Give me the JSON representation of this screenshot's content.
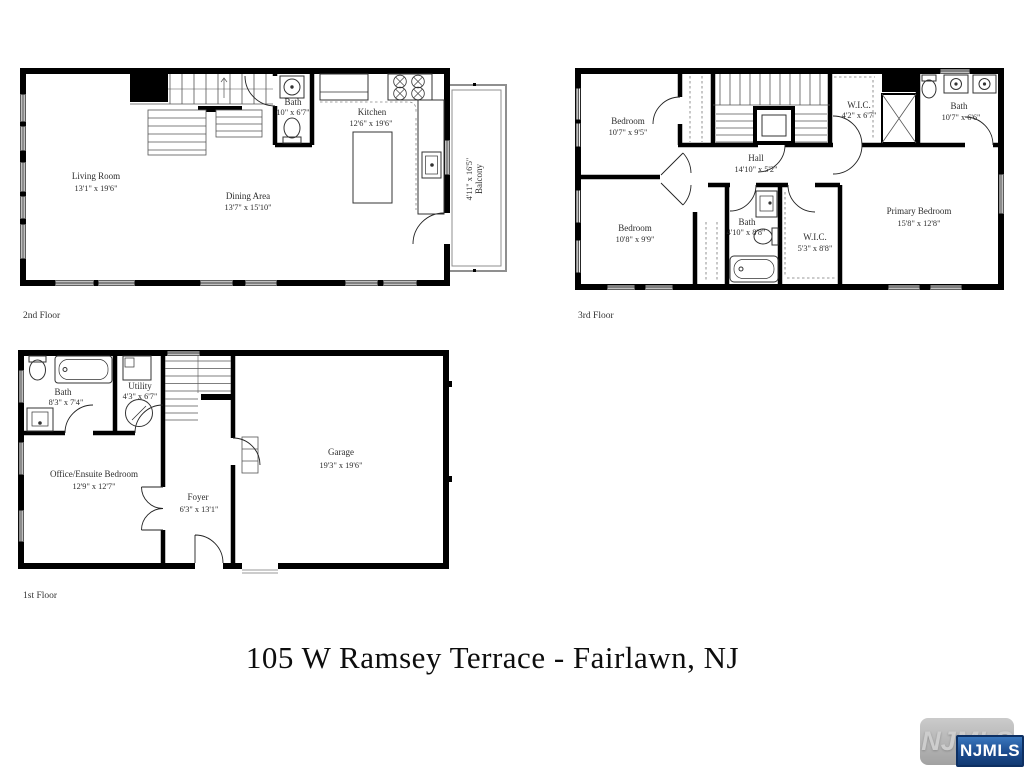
{
  "title": "105 W Ramsey Terrace - Fairlawn, NJ",
  "logo": {
    "watermark": "NJMLS",
    "badge": "NJMLS"
  },
  "colors": {
    "wall": "#000000",
    "balcony_outline": "#8f8f8f",
    "badge_blue_top": "#3a77bd",
    "badge_blue_bottom": "#123a72",
    "badge_border": "#0d2f62"
  },
  "floors": {
    "second": {
      "label": "2nd Floor",
      "rooms": {
        "living_room": {
          "name": "Living Room",
          "dims": "13'1\" x 19'6\""
        },
        "dining_area": {
          "name": "Dining Area",
          "dims": "13'7\" x 15'10\""
        },
        "kitchen": {
          "name": "Kitchen",
          "dims": "12'6\" x 19'6\""
        },
        "bath": {
          "name": "Bath",
          "dims": "10\" x 6'7\""
        },
        "balcony": {
          "name": "Balcony",
          "dims": "4'11\" x 16'5\""
        }
      }
    },
    "third": {
      "label": "3rd Floor",
      "rooms": {
        "bedroom_top": {
          "name": "Bedroom",
          "dims": "10'7\" x 9'5\""
        },
        "bedroom_bottom": {
          "name": "Bedroom",
          "dims": "10'8\" x 9'9\""
        },
        "hall": {
          "name": "Hall",
          "dims": "14'10\" x 5'2\""
        },
        "wic_top": {
          "name": "W.I.C.",
          "dims": "4'2\" x 6'7\""
        },
        "bath_top": {
          "name": "Bath",
          "dims": "10'7\" x 6'6\""
        },
        "bath_mid": {
          "name": "Bath",
          "dims": "4'10\" x 8'8\""
        },
        "wic_bottom": {
          "name": "W.I.C.",
          "dims": "5'3\" x 8'8\""
        },
        "primary_bedroom": {
          "name": "Primary Bedroom",
          "dims": "15'8\" x 12'8\""
        }
      }
    },
    "first": {
      "label": "1st Floor",
      "rooms": {
        "bath": {
          "name": "Bath",
          "dims": "8'3\" x 7'4\""
        },
        "utility": {
          "name": "Utility",
          "dims": "4'3\" x 6'7\""
        },
        "office": {
          "name": "Office/Ensuite Bedroom",
          "dims": "12'9\" x 12'7\""
        },
        "foyer": {
          "name": "Foyer",
          "dims": "6'3\" x 13'1\""
        },
        "garage": {
          "name": "Garage",
          "dims": "19'3\" x 19'6\""
        }
      }
    }
  }
}
